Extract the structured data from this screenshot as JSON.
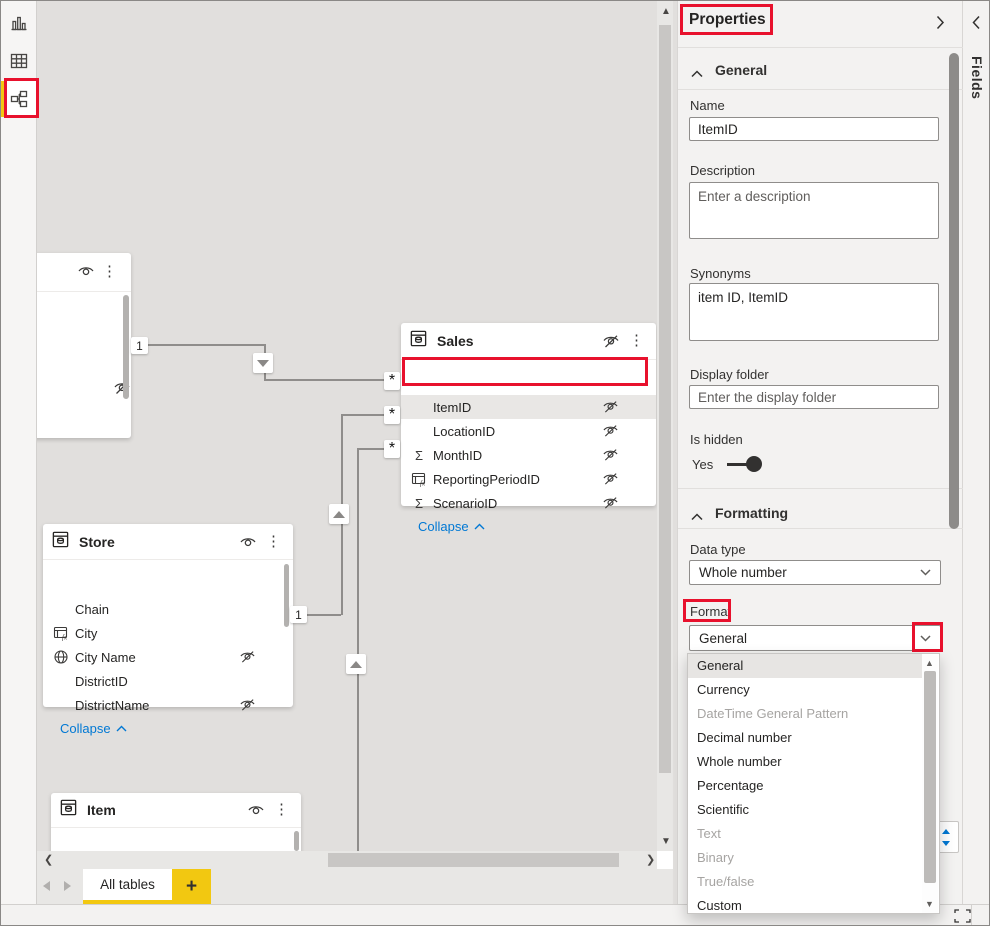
{
  "sidebar": {
    "items": [
      {
        "id": "report-view"
      },
      {
        "id": "data-view"
      },
      {
        "id": "model-view",
        "selected": true
      }
    ]
  },
  "canvas": {
    "relationship": {
      "one": "1",
      "many": "*"
    },
    "tables": {
      "sales": {
        "title": "Sales",
        "collapse_label": "Collapse",
        "fields": [
          {
            "name": "ItemID",
            "icon": "",
            "hidden": true,
            "selected": true
          },
          {
            "name": "LocationID",
            "icon": "",
            "hidden": true
          },
          {
            "name": "MonthID",
            "icon": "sigma",
            "hidden": true
          },
          {
            "name": "ReportingPeriodID",
            "icon": "calculated-column",
            "hidden": true
          },
          {
            "name": "ScenarioID",
            "icon": "sigma",
            "hidden": true
          }
        ]
      },
      "store": {
        "title": "Store",
        "collapse_label": "Collapse",
        "fields": [
          {
            "name": "Chain",
            "icon": ""
          },
          {
            "name": "City",
            "icon": "calculated-column"
          },
          {
            "name": "City Name",
            "icon": "globe",
            "hidden": true
          },
          {
            "name": "DistrictID",
            "icon": ""
          },
          {
            "name": "DistrictName",
            "icon": "",
            "hidden": true
          }
        ]
      },
      "item": {
        "title": "Item",
        "fields": [
          {
            "name": "Buyer",
            "icon": ""
          }
        ]
      }
    }
  },
  "bottom_bar": {
    "active_tab": "All tables",
    "add_button": "+"
  },
  "properties_pane": {
    "title": "Properties",
    "general_section": "General",
    "name": {
      "label": "Name",
      "value": "ItemID"
    },
    "description": {
      "label": "Description",
      "placeholder": "Enter a description"
    },
    "synonyms": {
      "label": "Synonyms",
      "value": "item ID, ItemID"
    },
    "display_folder": {
      "label": "Display folder",
      "placeholder": "Enter the display folder"
    },
    "is_hidden": {
      "label": "Is hidden",
      "value": "Yes"
    },
    "formatting_section": "Formatting",
    "data_type": {
      "label": "Data type",
      "value": "Whole number"
    },
    "format": {
      "label": "Format",
      "value": "General"
    },
    "format_options": [
      {
        "label": "General",
        "state": "selected"
      },
      {
        "label": "Currency",
        "state": "enabled"
      },
      {
        "label": "DateTime General Pattern",
        "state": "disabled"
      },
      {
        "label": "Decimal number",
        "state": "enabled"
      },
      {
        "label": "Whole number",
        "state": "enabled"
      },
      {
        "label": "Percentage",
        "state": "enabled"
      },
      {
        "label": "Scientific",
        "state": "enabled"
      },
      {
        "label": "Text",
        "state": "disabled"
      },
      {
        "label": "Binary",
        "state": "disabled"
      },
      {
        "label": "True/false",
        "state": "disabled"
      },
      {
        "label": "Custom",
        "state": "enabled"
      }
    ]
  },
  "fields_pane": {
    "title": "Fields"
  },
  "colors": {
    "accent": "#f2c811",
    "annotation": "#e8112d",
    "link": "#0078d4"
  }
}
